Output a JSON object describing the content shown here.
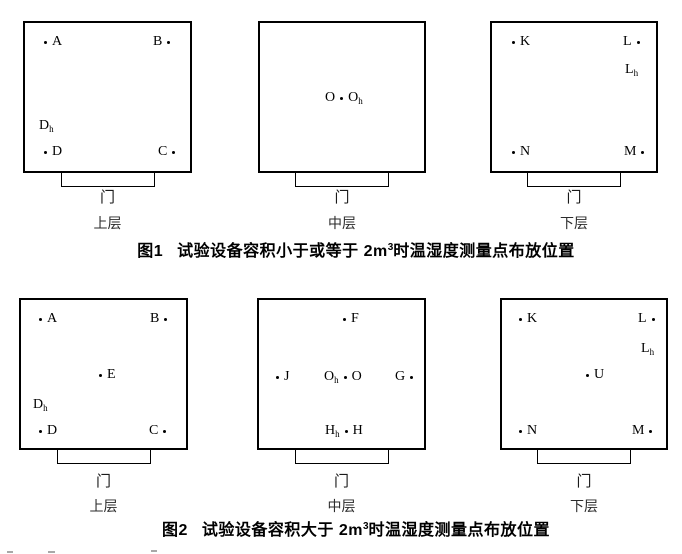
{
  "figures": [
    {
      "caption": {
        "label": "图1",
        "text": "试验设备容积小于或等于 2m",
        "sup": "3",
        "tail": "时温湿度测量点布放位置"
      },
      "panels": [
        {
          "door_label": "门",
          "layer_label": "上层",
          "points": [
            {
              "name": "A",
              "x": 21,
              "y": 21,
              "parts": [
                {
                  "dot": true
                },
                {
                  "t": "A"
                }
              ]
            },
            {
              "name": "B",
              "x": 130,
              "y": 21,
              "parts": [
                {
                  "t": "B"
                },
                {
                  "dot": true
                }
              ]
            },
            {
              "name": "Dh",
              "x": 16,
              "y": 105,
              "parts": [
                {
                  "t": "D",
                  "sub": "h"
                }
              ]
            },
            {
              "name": "D",
              "x": 21,
              "y": 131,
              "parts": [
                {
                  "dot": true
                },
                {
                  "t": "D"
                }
              ]
            },
            {
              "name": "C",
              "x": 135,
              "y": 131,
              "parts": [
                {
                  "t": "C"
                },
                {
                  "dot": true
                }
              ]
            }
          ]
        },
        {
          "door_label": "门",
          "layer_label": "中层",
          "points": [
            {
              "name": "O-Oh",
              "x": 67,
              "y": 77,
              "parts": [
                {
                  "t": "O"
                },
                {
                  "dot": true
                },
                {
                  "t": "O",
                  "sub": "h"
                }
              ]
            }
          ]
        },
        {
          "door_label": "门",
          "layer_label": "下层",
          "points": [
            {
              "name": "K",
              "x": 22,
              "y": 21,
              "parts": [
                {
                  "dot": true
                },
                {
                  "t": "K"
                }
              ]
            },
            {
              "name": "L",
              "x": 133,
              "y": 21,
              "parts": [
                {
                  "t": "L"
                },
                {
                  "dot": true
                }
              ]
            },
            {
              "name": "Lh",
              "x": 135,
              "y": 49,
              "parts": [
                {
                  "t": "L",
                  "sub": "h"
                }
              ]
            },
            {
              "name": "N",
              "x": 22,
              "y": 131,
              "parts": [
                {
                  "dot": true
                },
                {
                  "t": "N"
                }
              ]
            },
            {
              "name": "M",
              "x": 134,
              "y": 131,
              "parts": [
                {
                  "t": "M"
                },
                {
                  "dot": true
                }
              ]
            }
          ]
        }
      ]
    },
    {
      "caption": {
        "label": "图2",
        "text": "试验设备容积大于 2m",
        "sup": "3",
        "tail": "时温湿度测量点布放位置"
      },
      "panels": [
        {
          "door_label": "门",
          "layer_label": "上层",
          "points": [
            {
              "name": "A",
              "x": 20,
              "y": 21,
              "parts": [
                {
                  "dot": true
                },
                {
                  "t": "A"
                }
              ]
            },
            {
              "name": "B",
              "x": 131,
              "y": 21,
              "parts": [
                {
                  "t": "B"
                },
                {
                  "dot": true
                }
              ]
            },
            {
              "name": "E",
              "x": 80,
              "y": 77,
              "parts": [
                {
                  "dot": true
                },
                {
                  "t": "E"
                }
              ]
            },
            {
              "name": "Dh",
              "x": 14,
              "y": 107,
              "parts": [
                {
                  "t": "D",
                  "sub": "h"
                }
              ]
            },
            {
              "name": "D",
              "x": 20,
              "y": 133,
              "parts": [
                {
                  "dot": true
                },
                {
                  "t": "D"
                }
              ]
            },
            {
              "name": "C",
              "x": 130,
              "y": 133,
              "parts": [
                {
                  "t": "C"
                },
                {
                  "dot": true
                }
              ]
            }
          ]
        },
        {
          "door_label": "门",
          "layer_label": "中层",
          "points": [
            {
              "name": "F",
              "x": 86,
              "y": 21,
              "parts": [
                {
                  "dot": true
                },
                {
                  "t": "F"
                }
              ]
            },
            {
              "name": "J",
              "x": 19,
              "y": 79,
              "parts": [
                {
                  "dot": true
                },
                {
                  "t": "J"
                }
              ]
            },
            {
              "name": "Oh-O",
              "x": 67,
              "y": 79,
              "parts": [
                {
                  "t": "O",
                  "sub": "h"
                },
                {
                  "dot": true
                },
                {
                  "t": "O"
                }
              ]
            },
            {
              "name": "G",
              "x": 138,
              "y": 79,
              "parts": [
                {
                  "t": "G"
                },
                {
                  "dot": true
                }
              ]
            },
            {
              "name": "Hh-H",
              "x": 68,
              "y": 133,
              "parts": [
                {
                  "t": "H",
                  "sub": "h"
                },
                {
                  "dot": true
                },
                {
                  "t": "H"
                }
              ]
            }
          ]
        },
        {
          "door_label": "门",
          "layer_label": "下层",
          "points": [
            {
              "name": "K",
              "x": 19,
              "y": 21,
              "parts": [
                {
                  "dot": true
                },
                {
                  "t": "K"
                }
              ]
            },
            {
              "name": "L",
              "x": 138,
              "y": 21,
              "parts": [
                {
                  "t": "L"
                },
                {
                  "dot": true
                }
              ]
            },
            {
              "name": "Lh",
              "x": 141,
              "y": 51,
              "parts": [
                {
                  "t": "L",
                  "sub": "h"
                }
              ]
            },
            {
              "name": "U",
              "x": 86,
              "y": 77,
              "parts": [
                {
                  "dot": true
                },
                {
                  "t": "U"
                }
              ]
            },
            {
              "name": "N",
              "x": 19,
              "y": 133,
              "parts": [
                {
                  "dot": true
                },
                {
                  "t": "N"
                }
              ]
            },
            {
              "name": "M",
              "x": 132,
              "y": 133,
              "parts": [
                {
                  "t": "M"
                },
                {
                  "dot": true
                }
              ]
            }
          ]
        }
      ]
    }
  ]
}
